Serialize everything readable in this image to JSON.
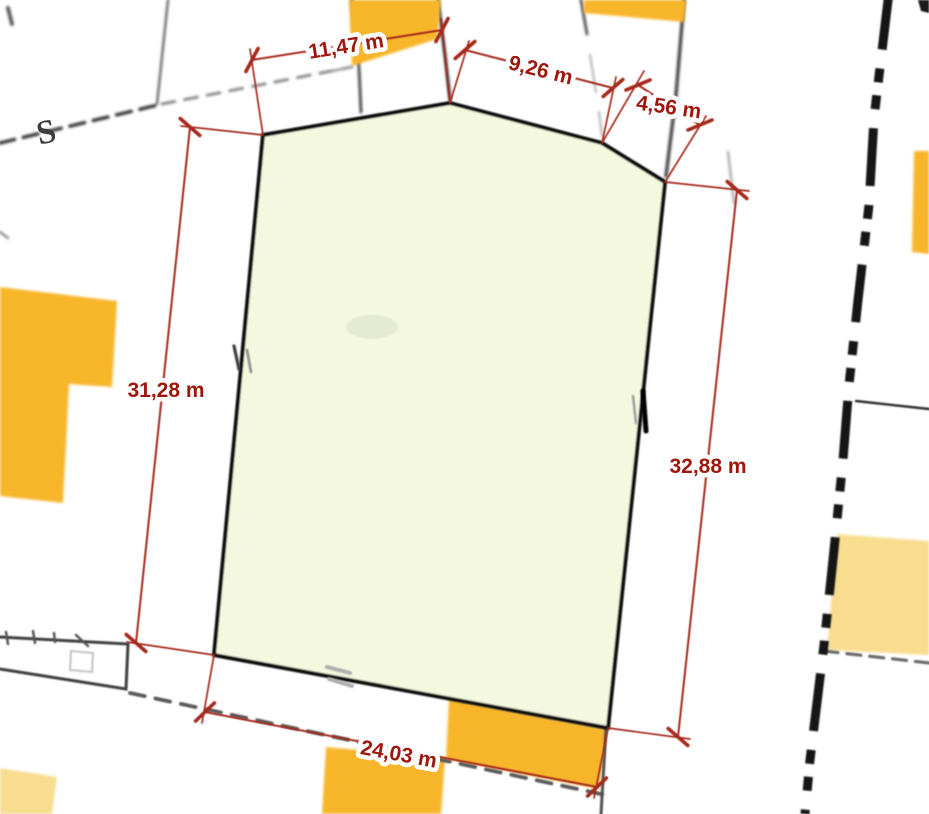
{
  "map": {
    "description": "Cadastral site plan with a highlighted parcel and measured boundary lengths",
    "parcel": {
      "highlighted": true,
      "edge_count": 6
    },
    "dimensions": [
      {
        "side": "top",
        "label": "11,47 m",
        "value_m": 11.47
      },
      {
        "side": "top-right-long",
        "label": "9,26 m",
        "value_m": 9.26
      },
      {
        "side": "top-right-short",
        "label": "4,56 m",
        "value_m": 4.56
      },
      {
        "side": "left",
        "label": "31,28 m",
        "value_m": 31.28
      },
      {
        "side": "right",
        "label": "32,88 m",
        "value_m": 32.88
      },
      {
        "side": "bottom",
        "label": "24,03 m",
        "value_m": 24.03
      }
    ],
    "symbols": {
      "boundary_s_marker": "S"
    },
    "colors": {
      "dimension_red": "#A52A1C",
      "label_red": "#9E170C",
      "parcel_fill": "#F3F8DF",
      "parcel_outline": "#101010",
      "building_orange": "#F7B52C",
      "building_pale_orange": "#F8DD8F",
      "boundary_dark": "#161616",
      "boundary_gray": "#5A5A5A",
      "background": "#FFFFFF"
    }
  }
}
